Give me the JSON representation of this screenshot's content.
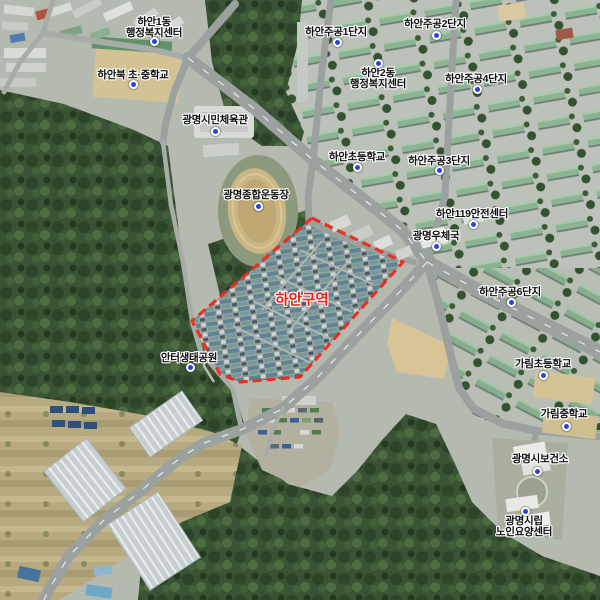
{
  "district": {
    "text": "하안구역",
    "cx": 302,
    "cy": 299
  },
  "boundary": {
    "color": "#ea2b1c",
    "points": [
      [
        312,
        218
      ],
      [
        403,
        262
      ],
      [
        300,
        377
      ],
      [
        240,
        382
      ],
      [
        220,
        374
      ],
      [
        192,
        321
      ]
    ]
  },
  "pois": [
    {
      "id": "haan1dong-welfare-center",
      "lines": [
        "하안1동",
        "행정복지센터"
      ],
      "cx": 154,
      "top": 17,
      "dot": {
        "x": 154,
        "y": 41
      },
      "dot_pos": "below"
    },
    {
      "id": "haanbuk-elem-middle-school",
      "lines": [
        "하안북 초·중학교"
      ],
      "cx": 133,
      "top": 70,
      "dot": {
        "x": 133,
        "y": 84
      },
      "dot_pos": "below"
    },
    {
      "id": "gwangmyeong-civic-gym",
      "lines": [
        "광명시민체육관"
      ],
      "cx": 215,
      "top": 115,
      "dot": {
        "x": 215,
        "y": 131
      },
      "dot_pos": "below"
    },
    {
      "id": "haan-jugong-1danji",
      "lines": [
        "하안주공1단지"
      ],
      "cx": 336,
      "top": 27,
      "dot": {
        "x": 337,
        "y": 42
      },
      "dot_pos": "below"
    },
    {
      "id": "haan-jugong-2danji",
      "lines": [
        "하안주공2단지"
      ],
      "cx": 435,
      "top": 19,
      "dot": {
        "x": 436,
        "y": 35
      },
      "dot_pos": "below"
    },
    {
      "id": "haan2dong-welfare-center",
      "lines": [
        "하안2동",
        "행정복지센터"
      ],
      "cx": 378,
      "top": 68,
      "dot": {
        "x": 378,
        "y": 63
      },
      "dot_pos": "above"
    },
    {
      "id": "haan-jugong-4danji",
      "lines": [
        "하안주공4단지"
      ],
      "cx": 476,
      "top": 74,
      "dot": {
        "x": 477,
        "y": 89
      },
      "dot_pos": "below"
    },
    {
      "id": "haan-elementary-school",
      "lines": [
        "하안초등학교"
      ],
      "cx": 357,
      "top": 152,
      "dot": {
        "x": 357,
        "y": 167
      },
      "dot_pos": "below"
    },
    {
      "id": "haan-jugong-3danji",
      "lines": [
        "하안주공3단지"
      ],
      "cx": 439,
      "top": 156,
      "dot": {
        "x": 439,
        "y": 170
      },
      "dot_pos": "below"
    },
    {
      "id": "gwangmyeong-stadium",
      "lines": [
        "광명종합운동장"
      ],
      "cx": 256,
      "top": 190,
      "dot": {
        "x": 258,
        "y": 206
      },
      "dot_pos": "below"
    },
    {
      "id": "haan-119-safety-center",
      "lines": [
        "하안119안전센터"
      ],
      "cx": 472,
      "top": 209,
      "dot": {
        "x": 473,
        "y": 224
      },
      "dot_pos": "below"
    },
    {
      "id": "gwangmyeong-post-office",
      "lines": [
        "광명우체국"
      ],
      "cx": 436,
      "top": 231,
      "dot": {
        "x": 436,
        "y": 246
      },
      "dot_pos": "below"
    },
    {
      "id": "haan-jugong-6danji",
      "lines": [
        "하안주공6단지"
      ],
      "cx": 510,
      "top": 287,
      "dot": {
        "x": 511,
        "y": 302
      },
      "dot_pos": "below"
    },
    {
      "id": "anteo-eco-park",
      "lines": [
        "안터생태공원"
      ],
      "cx": 189,
      "top": 353,
      "dot": {
        "x": 190,
        "y": 367
      },
      "dot_pos": "below"
    },
    {
      "id": "garim-elementary-school",
      "lines": [
        "가림초등학교"
      ],
      "cx": 543,
      "top": 359,
      "dot": {
        "x": 543,
        "y": 375
      },
      "dot_pos": "below"
    },
    {
      "id": "garim-middle-school",
      "lines": [
        "가림중학교"
      ],
      "cx": 564,
      "top": 409,
      "dot": {
        "x": 566,
        "y": 426
      },
      "dot_pos": "below"
    },
    {
      "id": "gwangmyeong-health-center",
      "lines": [
        "광명시보건소"
      ],
      "cx": 540,
      "top": 454,
      "dot": {
        "x": 537,
        "y": 471
      },
      "dot_pos": "below"
    },
    {
      "id": "gwangmyeong-elder-care-center",
      "lines": [
        "광명시립",
        "노인요양센터"
      ],
      "cx": 524,
      "top": 516,
      "dot": {
        "x": 525,
        "y": 511
      },
      "dot_pos": "above"
    }
  ],
  "palette": {
    "boundary_red": "#ea2b1c",
    "district_label_red": "#ee1d12",
    "poi_dot_blue": "#2742e0",
    "label_text": "#0d0d10",
    "label_halo": "#ffffff"
  }
}
